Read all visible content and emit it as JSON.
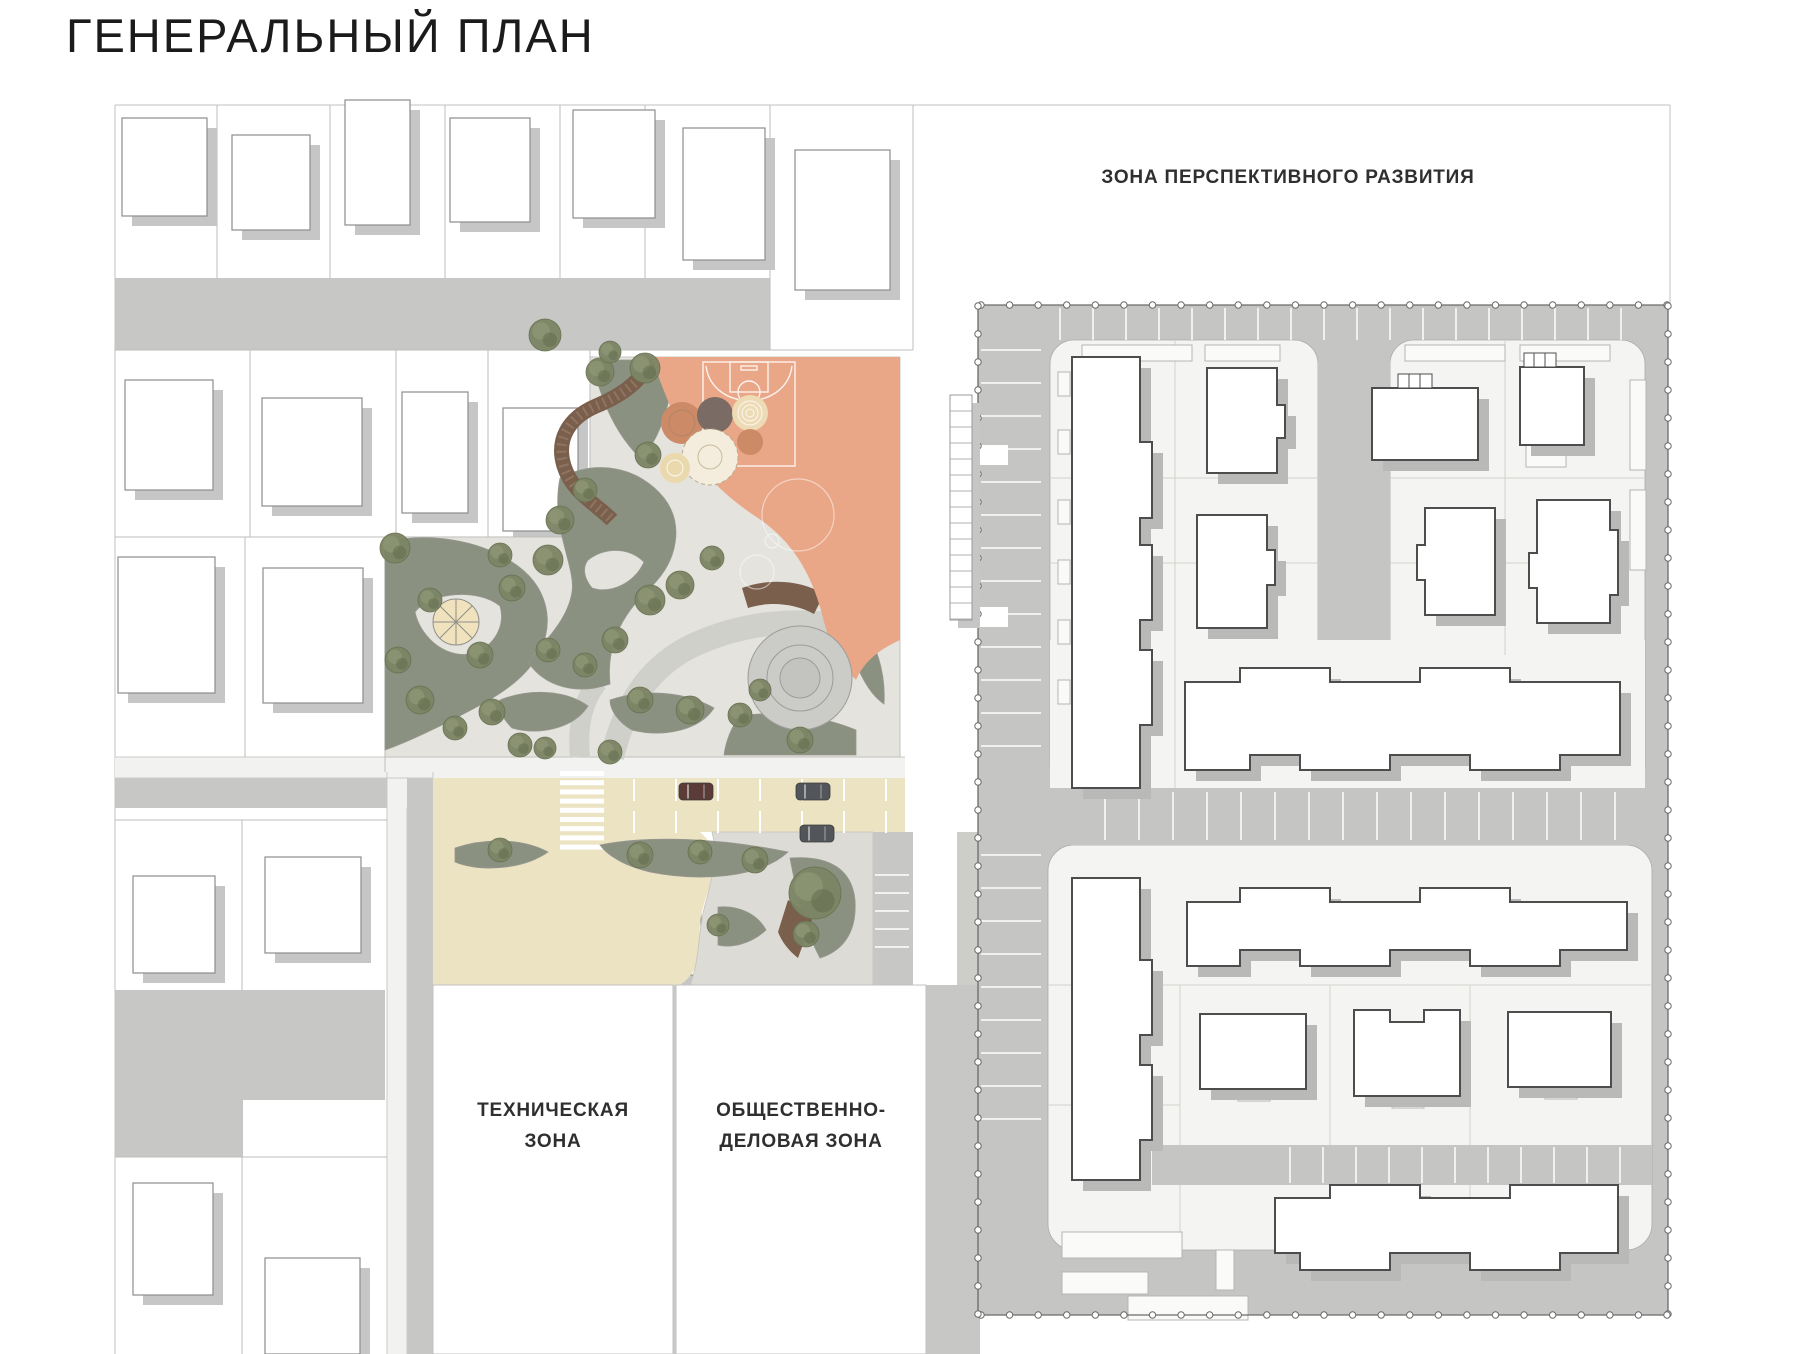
{
  "title": "ГЕНЕРАЛЬНЫЙ ПЛАН",
  "zones": {
    "development": "ЗОНА ПЕРСПЕКТИВНОГО РАЗВИТИЯ",
    "technical": "ТЕХНИЧЕСКАЯ\nЗОНА",
    "business": "ОБЩЕСТВЕННО-\nДЕЛОВАЯ ЗОНА"
  },
  "map": {
    "cars": [
      {
        "name": "car-red",
        "color": "#5a3b37",
        "x": 679,
        "y": 783
      },
      {
        "name": "car-gray-1",
        "color": "#52565a",
        "x": 796,
        "y": 783
      },
      {
        "name": "car-gray-2",
        "color": "#52565a",
        "x": 800,
        "y": 825
      }
    ],
    "palette": {
      "road_gray": "#c7c7c5",
      "block_road_gray": "#c5c5c3",
      "park_paving": "#e4e3de",
      "pocket_paving": "#dcdbd6",
      "greenery": "#8a9180",
      "tree": "#7d8566",
      "boardwalk_brown": "#7b5f4d",
      "sport_orange": "#e9a788",
      "plaza_beige": "#ece3c2",
      "playground_cream": "#f4ecdc",
      "playground_salmon": "#cd8a66",
      "playground_taupe": "#7a6b64",
      "courtyard_white": "#f4f4f2",
      "building_outline": "#4d4d4d",
      "building_shadow": "#b9b9b7",
      "cottage_shadow": "#c6c6c6",
      "boundary_dots": "#6a6a68"
    }
  }
}
